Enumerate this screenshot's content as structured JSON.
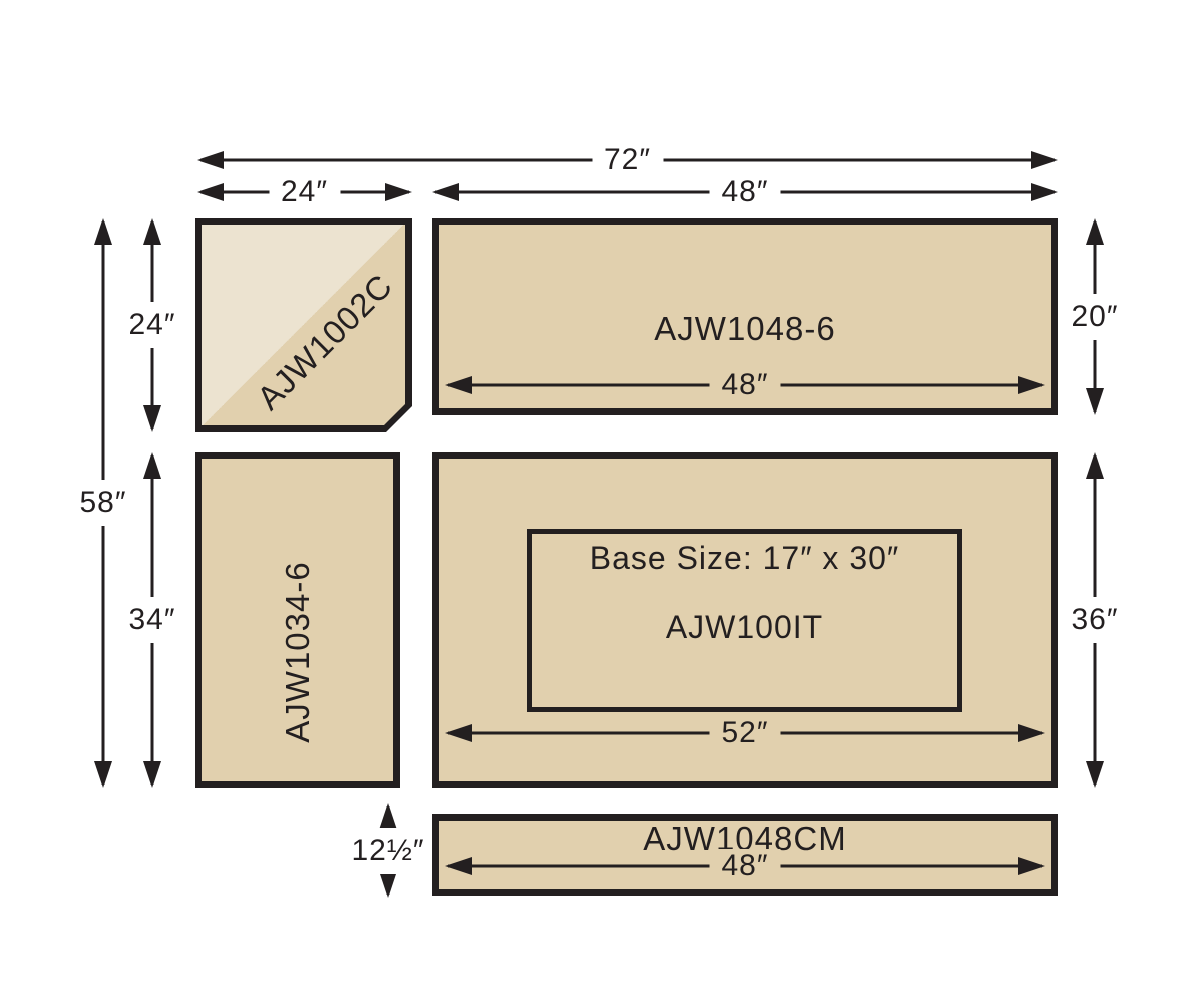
{
  "diagram": {
    "pieces": {
      "corner": {
        "label": "AJW1002C"
      },
      "top_counter": {
        "label": "AJW1048-6",
        "inner_width": "48″"
      },
      "left_counter": {
        "label": "AJW1034-6"
      },
      "island": {
        "label": "AJW100IT",
        "base_size": "Base Size: 17″ x 30″",
        "inner_width": "52″"
      },
      "cutting_board": {
        "label": "AJW1048CM",
        "inner_width": "48″"
      }
    },
    "dimensions": {
      "overall_width": "72″",
      "corner_width": "24″",
      "top_width": "48″",
      "overall_height": "58″",
      "corner_height": "24″",
      "left_height": "34″",
      "top_depth": "20″",
      "island_depth": "36″",
      "board_depth": "12½″"
    },
    "colors": {
      "surface": "#e1d0ae",
      "surface_light": "#ece3d0",
      "outline": "#231f20",
      "background": "#ffffff"
    }
  }
}
